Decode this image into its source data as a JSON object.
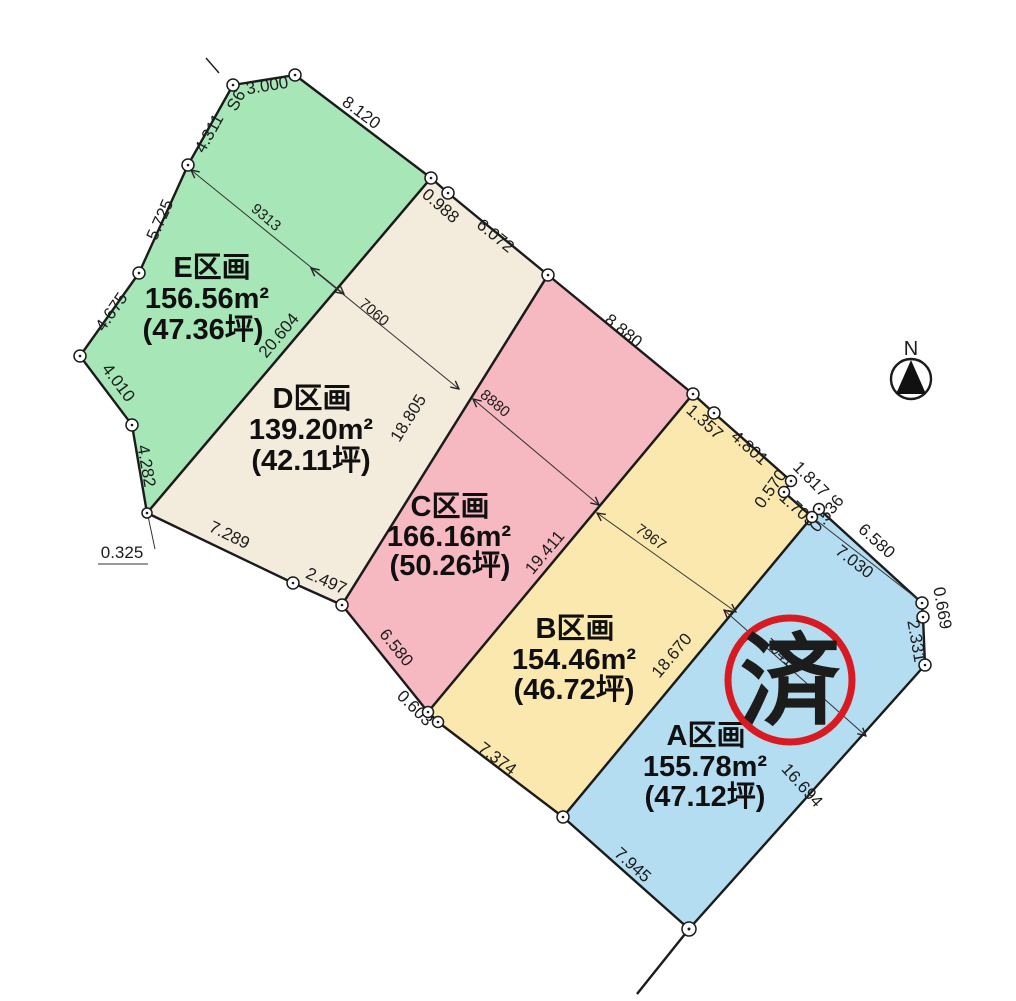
{
  "compass": {
    "label": "N"
  },
  "stamp": {
    "label": "済",
    "color": "#d81a22"
  },
  "colors": {
    "parcel_a": "#b5ddf2",
    "parcel_b": "#fbe8ae",
    "parcel_c": "#f6b9c2",
    "parcel_d": "#f3ecdd",
    "parcel_e": "#a7e6b7",
    "line": "#1b1b1b"
  },
  "parcels": [
    {
      "name": "A区画",
      "area": "155.78m²",
      "tsubo": "(47.12坪)"
    },
    {
      "name": "B区画",
      "area": "154.46m²",
      "tsubo": "(46.72坪)"
    },
    {
      "name": "C区画",
      "area": "166.16m²",
      "tsubo": "(50.26坪)"
    },
    {
      "name": "D区画",
      "area": "139.20m²",
      "tsubo": "(42.11坪)"
    },
    {
      "name": "E区画",
      "area": "156.56m²",
      "tsubo": "(47.36坪)"
    }
  ],
  "dims": {
    "s6": "S6",
    "d4311": "4.311",
    "d3000": "3.000",
    "d8120": "8.120",
    "d0988": "0.988",
    "d6072": "6.072",
    "d8880": "8.880",
    "d1357": "1.357",
    "d4801": "4.801",
    "d0570": "0.570",
    "d1817": "1.817",
    "d0536": "0.536",
    "d1703": "1.703",
    "d6580a": "6.580",
    "d7030": "7.030",
    "d0669": "0.669",
    "d2331": "2.331",
    "d16694": "16.694",
    "d7945": "7.945",
    "d18670": "18.670",
    "d7374": "7.374",
    "d0603": "0.603",
    "d6580c": "6.580",
    "d2497": "2.497",
    "d7289": "7.289",
    "d0325": "0.325",
    "d4282": "4.282",
    "d4010": "4.010",
    "d4675": "4.675",
    "d5725": "5.725",
    "d20604": "20.604",
    "d18805": "18.805",
    "d19411": "19.411"
  },
  "width_dims": {
    "w9313": "9313",
    "w7060": "7060",
    "w8880": "8880",
    "w7967": "7967",
    "w7941": "7941"
  }
}
